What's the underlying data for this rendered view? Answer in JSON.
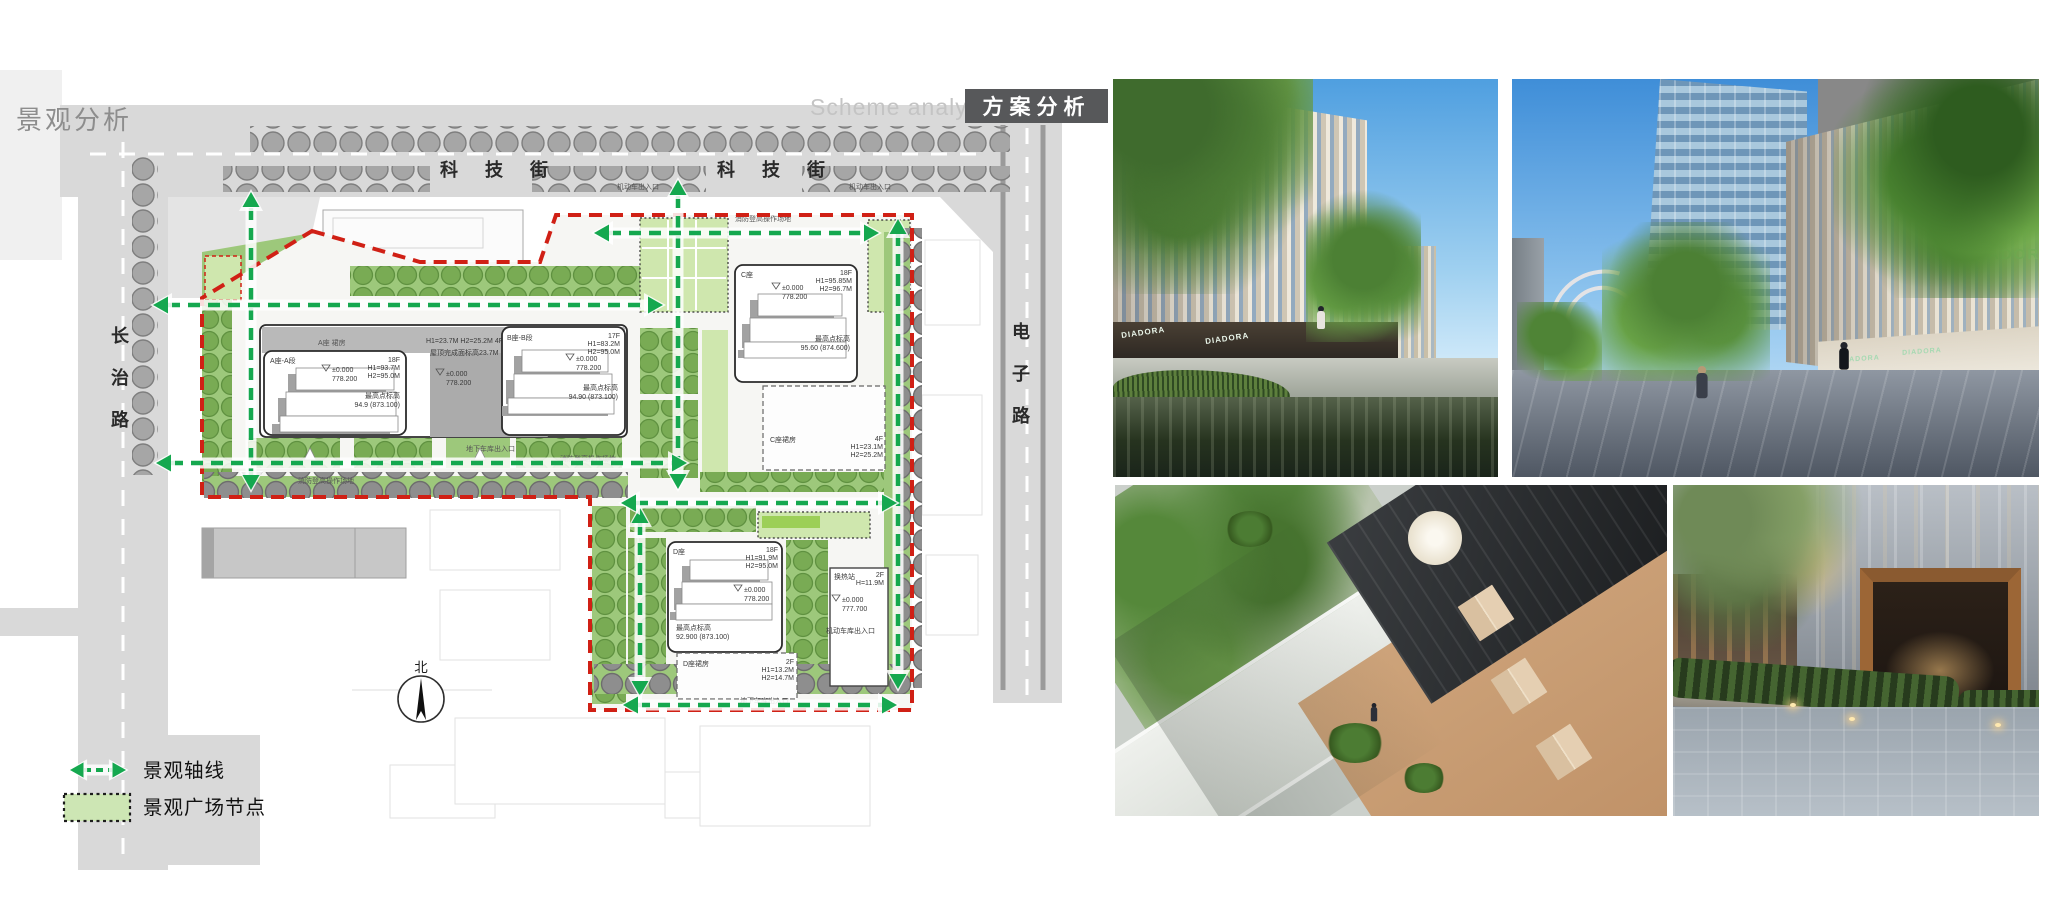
{
  "header": {
    "title": "景观分析",
    "scheme_en": "Scheme analysis",
    "scheme_zh": "方案分析"
  },
  "streets": {
    "keji_street_west": "科 技 街",
    "keji_street_east": "科 技 街",
    "changzhi_road": "长治路",
    "dianzi_road": "电子路"
  },
  "plan": {
    "north": "北",
    "fire_lane": "消防登高操作场地",
    "vehicle_entrance": "机动车出入口",
    "garage_entrance": "机动车库出入口",
    "underground_entrance": "地下车库出入口",
    "podium_ab": {
      "label": "A座 裙房",
      "height_info": "H1=23.7M H2=25.2M 4F",
      "roof_info": "屋顶完成面标高23.7M",
      "elev": "±0.000",
      "elev_val": "778.200"
    },
    "tower_a": {
      "name": "A座-A段",
      "floors": "18F",
      "h1": "H1=93.7M",
      "h2": "H2=95.0M",
      "elev": "±0.000",
      "elev_val": "778.200",
      "peak": "最高点标高",
      "peak_val": "94.9 (873.100)"
    },
    "tower_b": {
      "name": "B座-B段",
      "floors": "17F",
      "h1": "H1=83.2M",
      "h2": "H2=95.0M",
      "elev": "±0.000",
      "elev_val": "778.200",
      "peak": "最高点标高",
      "peak_val": "94.90 (873.100)"
    },
    "tower_c": {
      "name": "C座",
      "floors": "18F",
      "h1": "H1=95.85M",
      "h2": "H2=96.7M",
      "elev": "±0.000",
      "elev_val": "778.200",
      "peak": "最高点标高",
      "peak_val": "95.60 (874.600)"
    },
    "podium_c": {
      "name": "C座裙房",
      "floors": "4F",
      "h1": "H1=23.1M",
      "h2": "H2=25.2M"
    },
    "tower_d": {
      "name": "D座",
      "floors": "18F",
      "h1": "H1=91.9M",
      "h2": "H2=95.0M",
      "elev": "±0.000",
      "elev_val": "778.200",
      "peak": "最高点标高",
      "peak_val": "92.900 (873.100)"
    },
    "podium_d": {
      "name": "D座裙房",
      "floors": "2F",
      "h1": "H1=13.2M",
      "h2": "H2=14.7M"
    },
    "heat_station": {
      "name": "换热站",
      "floors": "2F",
      "h": "H=11.9M",
      "elev": "±0.000",
      "elev_val": "777.700"
    }
  },
  "legend": {
    "axis_label": "景观轴线",
    "node_label": "景观广场节点"
  },
  "photos": {
    "storefront_sign": "DIADORA"
  },
  "colors": {
    "axis_green": "#15a84f",
    "boundary_red": "#d02015",
    "plaza_light_green": "#cfe7ae",
    "strip_green": "#9dc87b",
    "header_box_gray": "#57585a",
    "road_gray": "#d9d9d9"
  }
}
